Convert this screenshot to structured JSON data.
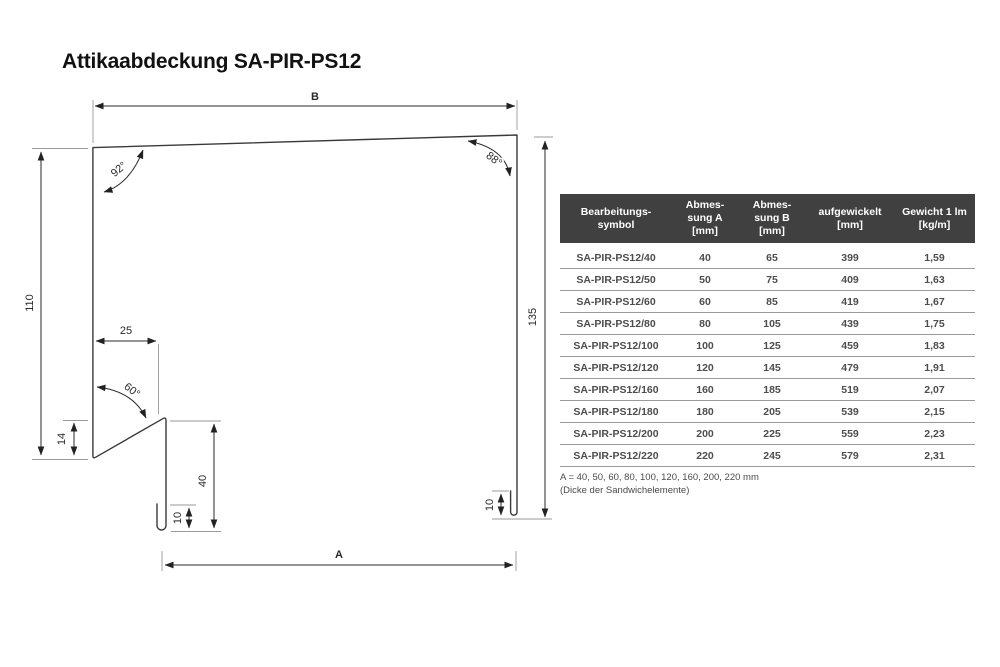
{
  "page": {
    "title": "Attikaabdeckung SA-PIR-PS12"
  },
  "colors": {
    "table_header_bg": "#404040",
    "table_header_text": "#ffffff",
    "table_text": "#4d4d4d",
    "row_divider": "#9a9a9a",
    "line_color": "#3a3a3a"
  },
  "drawing": {
    "dims": {
      "b": "B",
      "a": "A",
      "left_height": "110",
      "right_height": "135",
      "kink_offset": "25",
      "kink_height": "14",
      "leg_height": "40",
      "hem_left": "10",
      "hem_right": "10",
      "angle_top_left": "92°",
      "angle_top_right": "88°",
      "angle_kink": "60°"
    }
  },
  "table": {
    "headers": [
      "Bearbeitungs-\nsymbol",
      "Abmes-\nsung A\n[mm]",
      "Abmes-\nsung B\n[mm]",
      "aufgewickelt\n[mm]",
      "Gewicht 1 lm\n[kg/m]"
    ],
    "rows": [
      {
        "symbol": "SA-PIR-PS12/40",
        "a": "40",
        "b": "65",
        "coil": "399",
        "weight": "1,59"
      },
      {
        "symbol": "SA-PIR-PS12/50",
        "a": "50",
        "b": "75",
        "coil": "409",
        "weight": "1,63"
      },
      {
        "symbol": "SA-PIR-PS12/60",
        "a": "60",
        "b": "85",
        "coil": "419",
        "weight": "1,67"
      },
      {
        "symbol": "SA-PIR-PS12/80",
        "a": "80",
        "b": "105",
        "coil": "439",
        "weight": "1,75"
      },
      {
        "symbol": "SA-PIR-PS12/100",
        "a": "100",
        "b": "125",
        "coil": "459",
        "weight": "1,83"
      },
      {
        "symbol": "SA-PIR-PS12/120",
        "a": "120",
        "b": "145",
        "coil": "479",
        "weight": "1,91"
      },
      {
        "symbol": "SA-PIR-PS12/160",
        "a": "160",
        "b": "185",
        "coil": "519",
        "weight": "2,07"
      },
      {
        "symbol": "SA-PIR-PS12/180",
        "a": "180",
        "b": "205",
        "coil": "539",
        "weight": "2,15"
      },
      {
        "symbol": "SA-PIR-PS12/200",
        "a": "200",
        "b": "225",
        "coil": "559",
        "weight": "2,23"
      },
      {
        "symbol": "SA-PIR-PS12/220",
        "a": "220",
        "b": "245",
        "coil": "579",
        "weight": "2,31"
      }
    ],
    "footnote_line1": "A = 40, 50, 60, 80, 100, 120, 160, 200, 220 mm",
    "footnote_line2": "(Dicke der Sandwichelemente)"
  }
}
